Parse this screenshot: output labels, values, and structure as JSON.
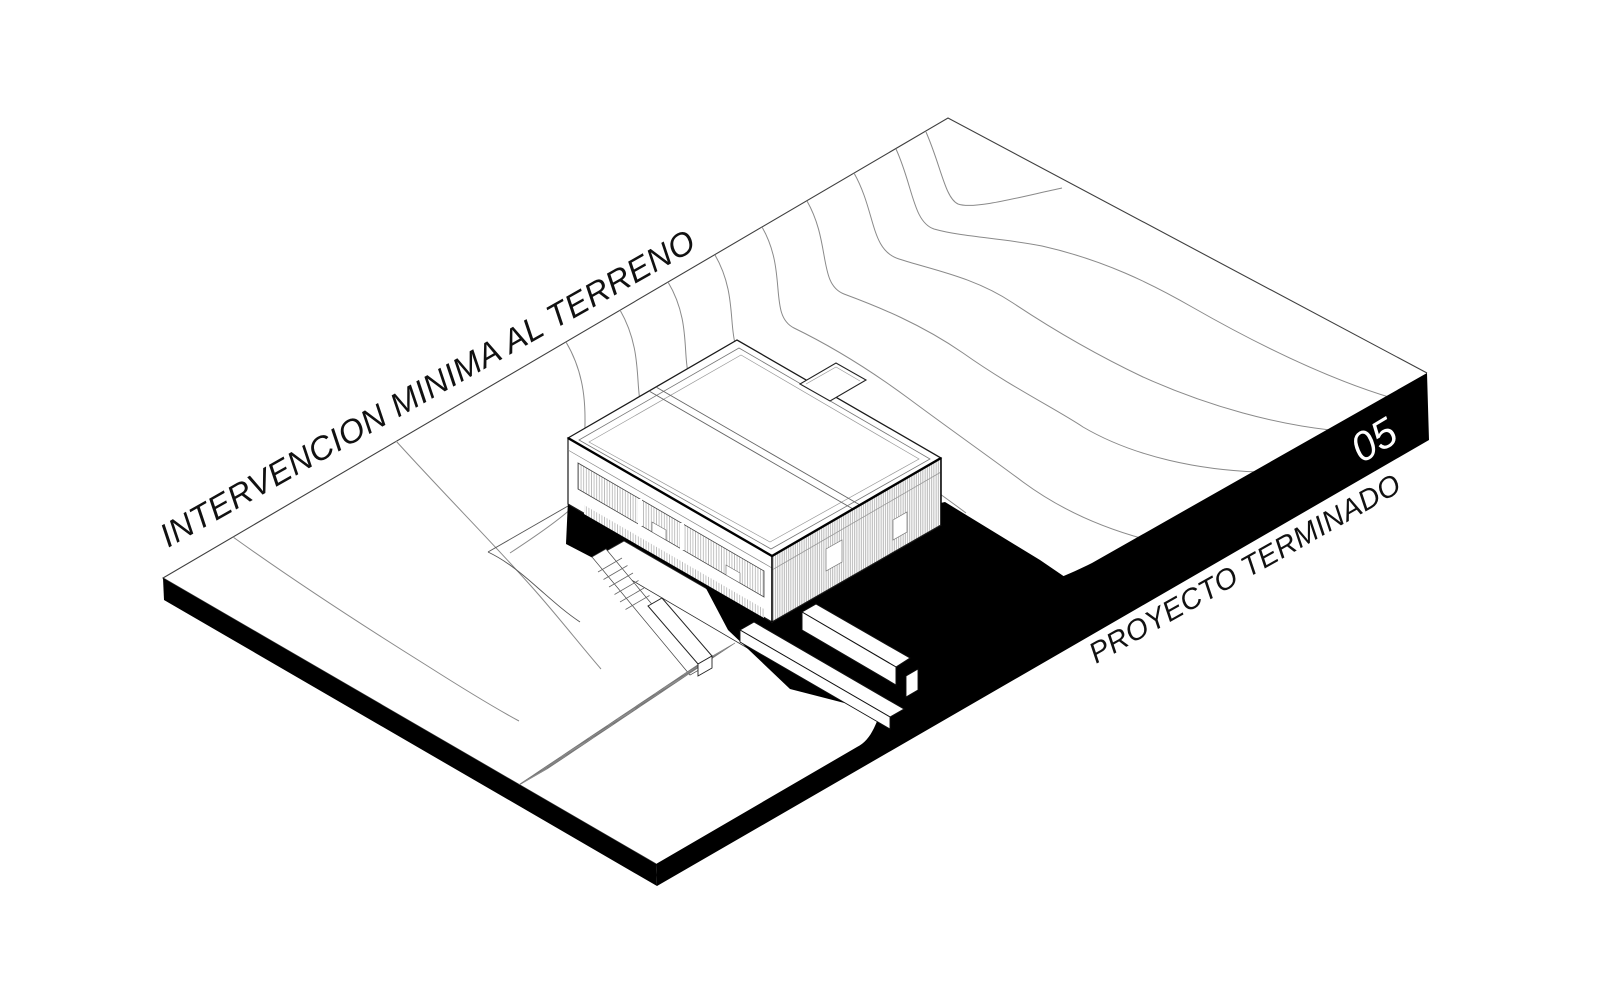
{
  "page": {
    "background": "#ffffff"
  },
  "diagram": {
    "type": "axonometric-site-diagram",
    "labels": {
      "site_annotation": "INTERVENCION MINIMA AL TERRENO",
      "sheet_number": "05",
      "status_annotation": "PROYECTO TERMINADO"
    },
    "colors": {
      "background": "#ffffff",
      "linework": "#1a1a1a",
      "contour_line": "#8a8a8a",
      "solid_black": "#000000",
      "sheet_number_text": "#ffffff",
      "annotation_text": "#111111"
    }
  }
}
